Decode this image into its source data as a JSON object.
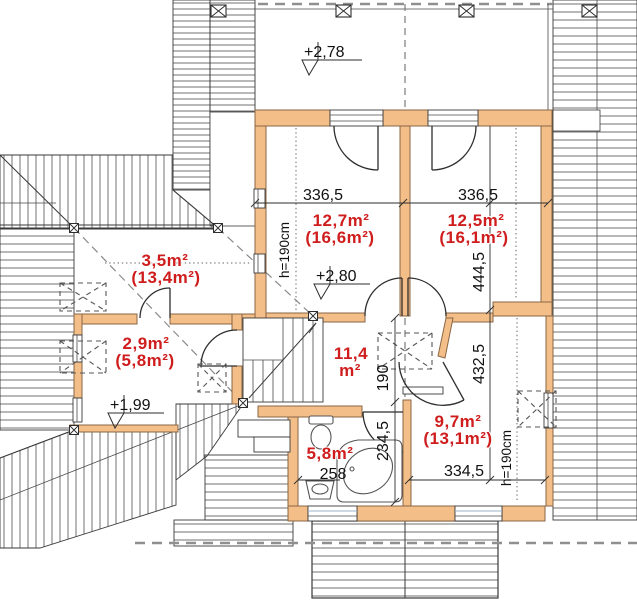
{
  "plan": {
    "type": "attic floor plan",
    "colors": {
      "wall_fill": "#F3BE88",
      "area_label_red": "#CF1D1D",
      "line": "#3A3A3A",
      "roof_dash_gray": "#8F8F8F"
    },
    "balcony": {
      "level": "+2,78"
    },
    "rooms": [
      {
        "id": "bedroom-left",
        "area": "12,7m²",
        "floor_area": "(16,6m²)",
        "width": "336,5",
        "height_note": "h=190cm",
        "level": "+2,80"
      },
      {
        "id": "bedroom-right",
        "area": "12,5m²",
        "floor_area": "(16,1m²)",
        "width": "336,5",
        "depth": "444,5"
      },
      {
        "id": "storage-upper-left",
        "area": "3,5m²",
        "floor_area": "(13,4m²)"
      },
      {
        "id": "storage-lower-left",
        "area": "2,9m²",
        "floor_area": "(5,8m²)",
        "level": "+1,99"
      },
      {
        "id": "hall",
        "area_line1": "11,4",
        "area_line2": "m²"
      },
      {
        "id": "bathroom",
        "area": "5,8m²",
        "width": "258",
        "depth": "234,5",
        "door": "190"
      },
      {
        "id": "room-lower-right",
        "area": "9,7m²",
        "floor_area": "(13,1m²)",
        "width": "334,5",
        "depth": "432,5",
        "height_note": "h=190cm"
      }
    ]
  }
}
